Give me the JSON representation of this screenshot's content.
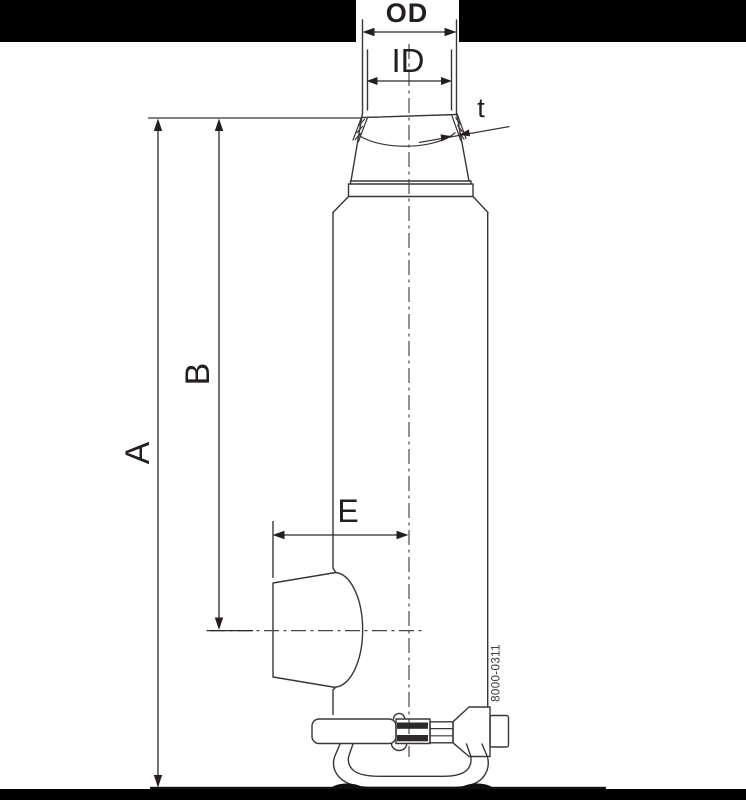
{
  "drawing": {
    "labels": {
      "od": "OD",
      "id": "ID",
      "t": "t",
      "a": "A",
      "b": "B",
      "e": "E"
    },
    "part_number": "8000-0311",
    "colors": {
      "line": "#3a3637",
      "text": "#231f20",
      "background": "#ffffff",
      "mask_bar": "#000000"
    }
  }
}
